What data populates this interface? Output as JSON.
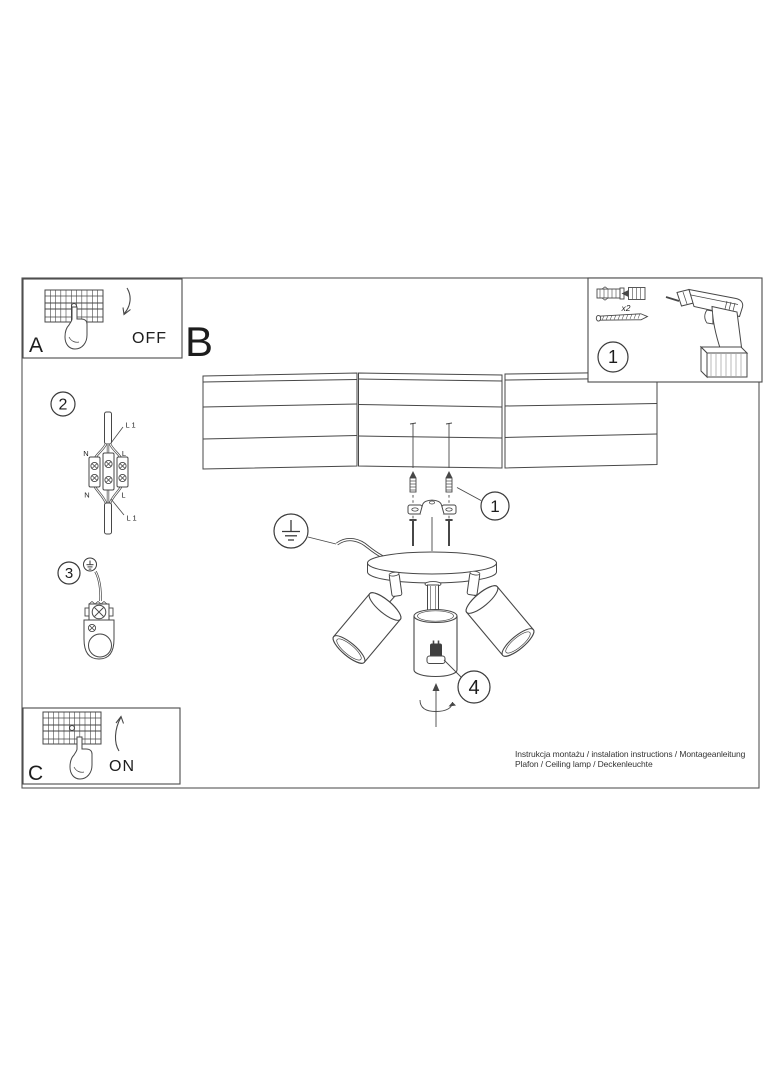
{
  "document": {
    "kind": "lamp assembly instruction sheet"
  },
  "labels": {
    "section_a": "A",
    "section_b": "B",
    "section_c": "C",
    "power_off": "OFF",
    "power_on": "ON"
  },
  "callouts": {
    "tools_step": "1",
    "screws_step": "1",
    "wiring_step": "2",
    "grounding_step": "3",
    "bulb_step": "4"
  },
  "tools_box": {
    "anchor_quantity": "x2"
  },
  "wiring_labels": {
    "top_cable": "L 1",
    "neutral_top": "N",
    "live_top": "L",
    "neutral_bottom": "N",
    "live_bottom": "L",
    "bottom_cable": "L 1"
  },
  "footer": {
    "line1": "Instrukcja montażu / instalation instructions / Montageanleitung",
    "line2": "Plafon / Ceiling lamp / Deckenleuchte"
  }
}
